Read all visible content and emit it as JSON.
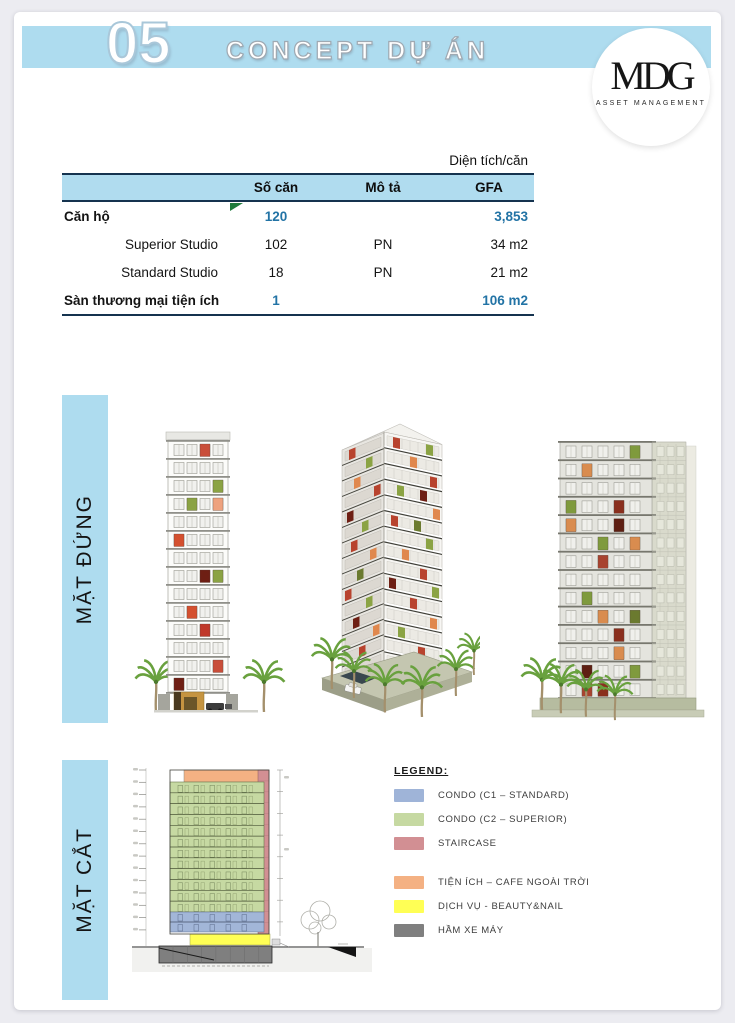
{
  "header": {
    "section_number": "05",
    "title": "CONCEPT DỰ ÁN",
    "logo": {
      "monogram": "MDG",
      "subtitle": "ASSET MANAGEMENT"
    }
  },
  "table": {
    "caption": "Diện tích/căn",
    "columns": [
      "",
      "Số căn",
      "Mô tả",
      "GFA"
    ],
    "rows": [
      {
        "name": "Căn hộ",
        "so_can": "120",
        "mo_ta": "",
        "gfa": "3,853"
      },
      {
        "name": "Superior Studio",
        "so_can": "102",
        "mo_ta": "PN",
        "gfa": "34 m2"
      },
      {
        "name": "Standard Studio",
        "so_can": "18",
        "mo_ta": "PN",
        "gfa": "21 m2"
      },
      {
        "name": "Sàn thương mại tiện ích",
        "so_can": "1",
        "mo_ta": "",
        "gfa": "106 m2"
      }
    ]
  },
  "sections": [
    {
      "label": "MẶT ĐỨNG"
    },
    {
      "label": "MẶT CẮT"
    }
  ],
  "legend": {
    "title": "LEGEND:",
    "items": [
      {
        "label": "CONDO (C1 – STANDARD)",
        "color": "#9fb4d8"
      },
      {
        "label": "CONDO (C2 – SUPERIOR)",
        "color": "#c6d9a2"
      },
      {
        "label": "STAIRCASE",
        "color": "#d28f93"
      },
      {
        "label": "TIỆN ÍCH – CAFE NGOÀI TRỜI",
        "color": "#f4b183"
      },
      {
        "label": "DỊCH VỤ - BEAUTY&NAIL",
        "color": "#ffff55"
      },
      {
        "label": "HẦM XE MÁY",
        "color": "#7f7f7f"
      }
    ]
  },
  "colors": {
    "banner_blue": "#aedcef",
    "table_header_blue": "#b0dcef",
    "value_text_blue": "#2273a5",
    "table_border": "#15334f",
    "comment_flag_green": "#1f7a3c"
  }
}
